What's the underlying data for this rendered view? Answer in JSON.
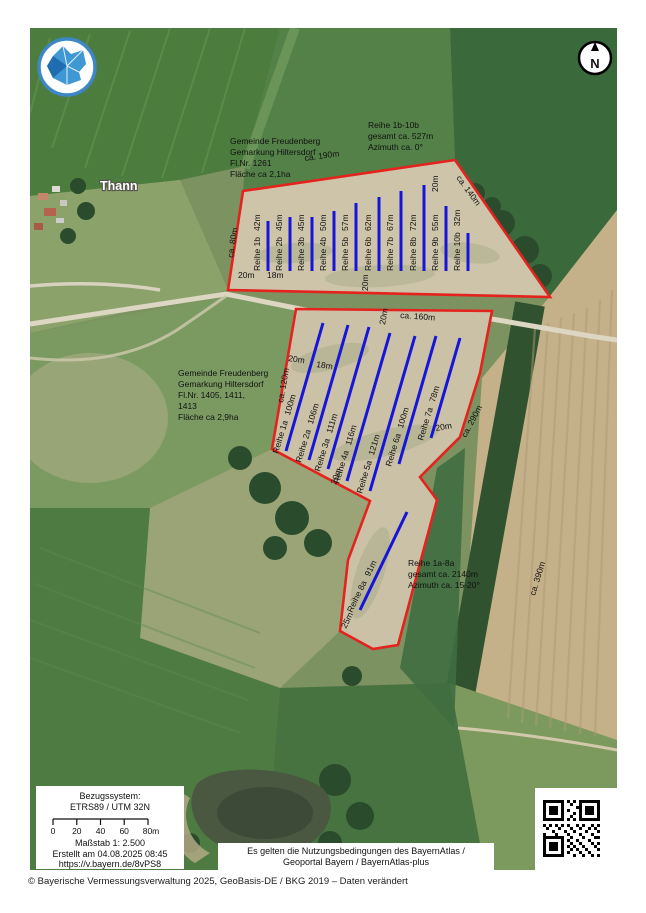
{
  "colors": {
    "boundary": "#e4231e",
    "row_line": "#1616d9"
  },
  "map": {
    "place_label": "Thann",
    "north_label": "N",
    "right_field_edge": "ca. 390m",
    "dims": {
      "d20": "20m",
      "d18": "18m",
      "d25": "25m"
    },
    "field_b": {
      "info": [
        "Gemeinde Freudenberg",
        "Gemarkung Hiltersdorf",
        "Fl.Nr. 1261",
        "Fläche ca 2,1ha"
      ],
      "summary": [
        "Reihe 1b-10b",
        "gesamt ca. 527m",
        "Azimuth ca. 0°"
      ],
      "edge_top": "ca. 190m",
      "edge_left": "ca. 80m",
      "edge_right": "ca. 140m",
      "rows": [
        {
          "name": "Reihe 1b",
          "len": "42m"
        },
        {
          "name": "Reihe 2b",
          "len": "45m"
        },
        {
          "name": "Reihe 3b",
          "len": "45m"
        },
        {
          "name": "Reihe 4b",
          "len": "50m"
        },
        {
          "name": "Reihe 5b",
          "len": "57m"
        },
        {
          "name": "Reihe 6b",
          "len": "62m"
        },
        {
          "name": "Reihe 7b",
          "len": "67m"
        },
        {
          "name": "Reihe 8b",
          "len": "72m"
        },
        {
          "name": "Reihe 9b",
          "len": "55m"
        },
        {
          "name": "Reihe 10b",
          "len": "32m"
        }
      ]
    },
    "field_a": {
      "info": [
        "Gemeinde Freudenberg",
        "Gemarkung Hiltersdorf",
        "Fl.Nr. 1405, 1411,",
        "1413",
        "Fläche ca 2,9ha"
      ],
      "summary": [
        "Reihe 1a-8a",
        "gesamt ca. 2140m",
        "Azimuth ca. 15-20°"
      ],
      "edge_top": "ca. 160m",
      "edge_left": "ca. 120m",
      "edge_right": "ca. 290m",
      "rows": [
        {
          "name": "Reihe 1a",
          "len": "100m"
        },
        {
          "name": "Reihe 2a",
          "len": "106m"
        },
        {
          "name": "Reihe 3a",
          "len": "111m"
        },
        {
          "name": "Reihe 4a",
          "len": "116m"
        },
        {
          "name": "Reihe 5a",
          "len": "121m"
        },
        {
          "name": "Reihe 6a",
          "len": "100m"
        },
        {
          "name": "Reihe 7a",
          "len": "78m"
        },
        {
          "name": "Reihe 8a",
          "len": "91m"
        }
      ]
    },
    "scale_box": {
      "ref_title": "Bezugssystem:",
      "ref_system": "ETRS89 / UTM 32N",
      "ticks": [
        "0",
        "20",
        "40",
        "60",
        "80m"
      ],
      "scale": "Maßstab 1: 2.500",
      "created": "Erstellt am 04.08.2025 08:45",
      "url": "https://v.bayern.de/8vPS8"
    },
    "usage_box": {
      "line1": "Es gelten die Nutzungsbedingungen des BayernAtlas /",
      "line2": "Geoportal Bayern / BayernAtlas-plus"
    }
  },
  "footer": "© Bayerische Vermessungsverwaltung 2025, GeoBasis-DE / BKG 2019 – Daten verändert"
}
